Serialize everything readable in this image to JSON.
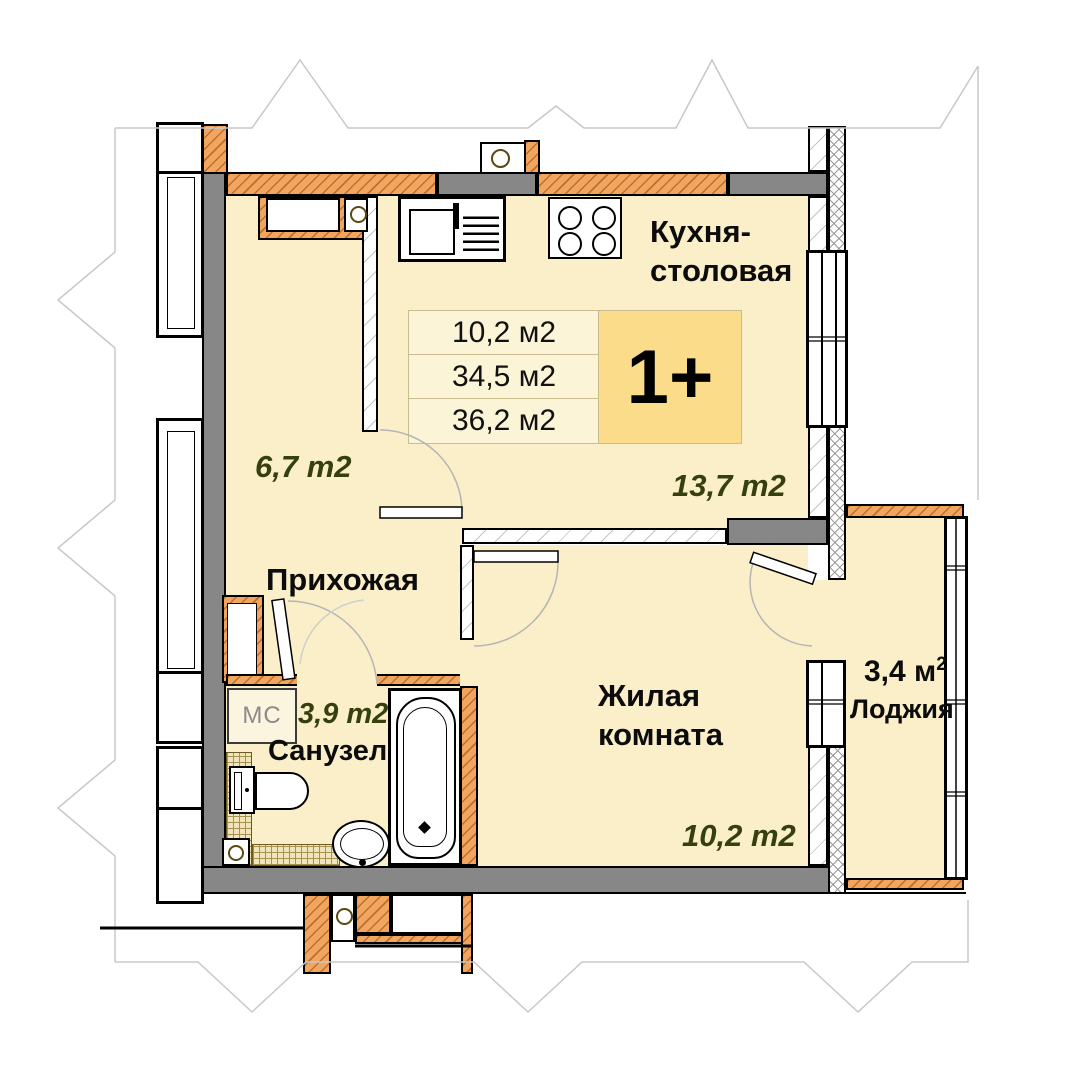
{
  "plan": {
    "unit_badge": "1+",
    "area_table": {
      "rows": [
        "10,2 м2",
        "34,5 м2",
        "36,2 м2"
      ]
    },
    "rooms": {
      "kitchen": {
        "name_line1": "Кухня-",
        "name_line2": "столовая",
        "area": "13,7 m2"
      },
      "hallway": {
        "name": "Прихожая",
        "area": "6,7 m2"
      },
      "living": {
        "name_line1": "Жилая",
        "name_line2": "комната",
        "area": "10,2 m2"
      },
      "bathroom": {
        "name": "Санузел",
        "area": "3,9 m2"
      },
      "loggia": {
        "name": "Лоджия",
        "area_value": "3,4 м",
        "area_sup": "2"
      }
    },
    "fixtures": {
      "washing_machine_label": "МС"
    },
    "colors": {
      "floor": "#FAEFC8",
      "brick_wall": "#F2A55E",
      "concrete_wall": "#878787",
      "badge_bg": "#FBDC8A",
      "table_bg": "#FCF4D6",
      "area_label_text": "#36400F"
    }
  }
}
